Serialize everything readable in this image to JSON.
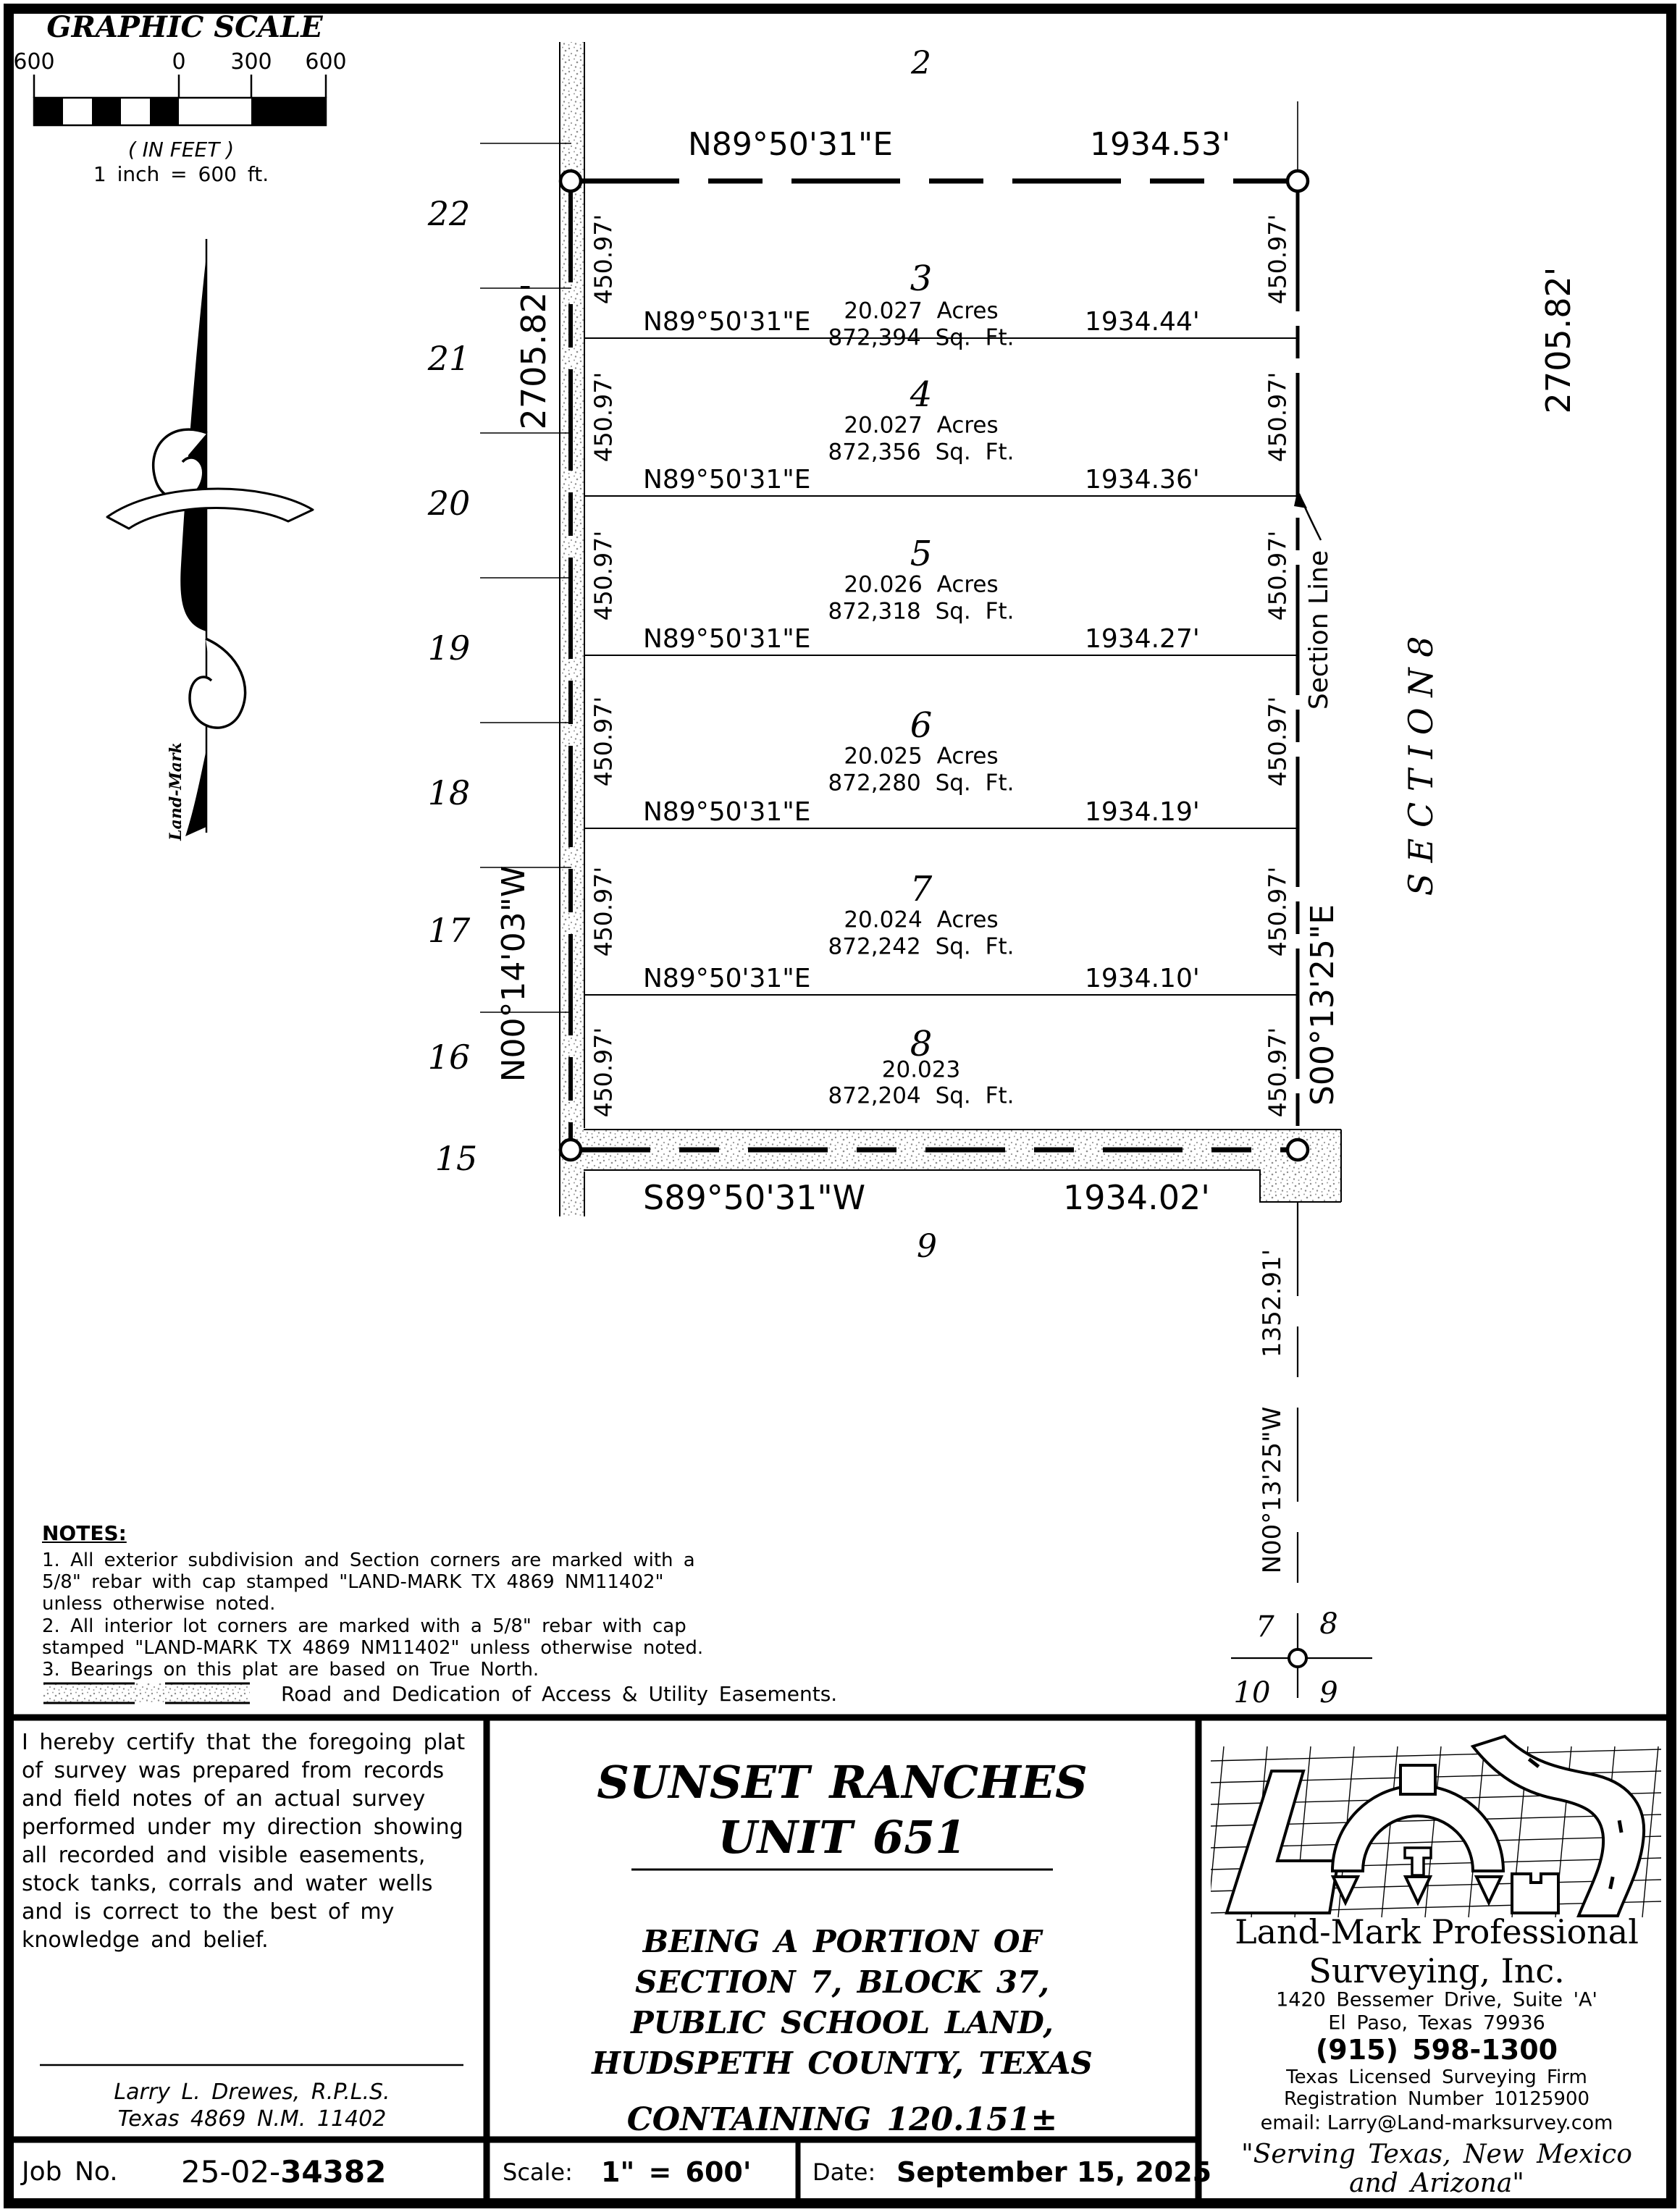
{
  "scale_bar": {
    "title": "GRAPHIC SCALE",
    "tick_labels": [
      "600",
      "0",
      "300",
      "600"
    ],
    "caption": "( IN FEET )",
    "equivalence": "1 inch  =  600 ft."
  },
  "north_arrow_label": "Land-Mark",
  "plat": {
    "north_neighbor": "2",
    "south_neighbor": "9",
    "west_neighbors": [
      "22",
      "21",
      "20",
      "19",
      "18",
      "17",
      "16",
      "15"
    ],
    "north_line": {
      "bearing": "N89°50'31\"E",
      "distance": "1934.53'"
    },
    "south_line": {
      "bearing": "S89°50'31\"W",
      "distance": "1934.02'"
    },
    "west_line": {
      "bearing": "N00°14'03\"W",
      "distance": "2705.82'"
    },
    "east_line": {
      "bearing": "S00°13'25\"E",
      "distance": "2705.82'"
    },
    "lots": [
      {
        "number": "3",
        "area_acres": "20.027 Acres",
        "area_sqft": "872,394 Sq. Ft.",
        "south_bearing": "N89°50'31\"E",
        "south_distance": "1934.44'",
        "side_length": "450.97'"
      },
      {
        "number": "4",
        "area_acres": "20.027 Acres",
        "area_sqft": "872,356 Sq. Ft.",
        "south_bearing": "N89°50'31\"E",
        "south_distance": "1934.36'",
        "side_length": "450.97'"
      },
      {
        "number": "5",
        "area_acres": "20.026 Acres",
        "area_sqft": "872,318 Sq. Ft.",
        "south_bearing": "N89°50'31\"E",
        "south_distance": "1934.27'",
        "side_length": "450.97'"
      },
      {
        "number": "6",
        "area_acres": "20.025 Acres",
        "area_sqft": "872,280 Sq. Ft.",
        "south_bearing": "N89°50'31\"E",
        "south_distance": "1934.19'",
        "side_length": "450.97'"
      },
      {
        "number": "7",
        "area_acres": "20.024 Acres",
        "area_sqft": "872,242 Sq. Ft.",
        "south_bearing": "N89°50'31\"E",
        "south_distance": "1934.10'",
        "side_length": "450.97'"
      },
      {
        "number": "8",
        "area_acres": "20.023",
        "area_sqft": "872,204 Sq. Ft.",
        "side_length": "450.97'"
      }
    ],
    "section_label": "S E C T I O N   8",
    "section_line_callout": "Section Line",
    "south_extension": {
      "distance": "1352.91'",
      "bearing": "N00°13'25\"W"
    },
    "section_corner": {
      "nw": "7",
      "ne": "8",
      "sw": "10",
      "se": "9"
    }
  },
  "notes": {
    "title": "NOTES:",
    "lines": [
      "1. All exterior subdivision and Section corners are marked with a",
      "5/8\" rebar with cap stamped \"LAND-MARK TX 4869 NM11402\"",
      "unless otherwise noted.",
      "2. All interior lot corners are marked with a 5/8\" rebar with cap",
      "stamped \"LAND-MARK TX 4869 NM11402\" unless otherwise noted.",
      "3. Bearings on this plat are based on True North."
    ]
  },
  "legend": {
    "road_easement": "Road and Dedication of Access & Utility Easements."
  },
  "certificate": {
    "lines": [
      "I hereby certify that the foregoing plat",
      "of survey was prepared from records",
      "and field notes of an actual survey",
      "performed under my direction showing",
      "all recorded and visible easements,",
      "stock tanks, corrals and water wells",
      "and is correct to the best of my",
      "knowledge and belief."
    ],
    "surveyor": "Larry L. Drewes, R.P.L.S.",
    "license": "Texas 4869 N.M. 11402"
  },
  "title_block": {
    "title_line1": "SUNSET RANCHES",
    "title_line2": "UNIT 651",
    "subtitle_lines": [
      "BEING A PORTION OF",
      "SECTION 7, BLOCK 37,",
      "PUBLIC SCHOOL LAND,",
      "HUDSPETH COUNTY, TEXAS"
    ],
    "containing": "CONTAINING 120.151±"
  },
  "firm": {
    "name_line1": "Land-Mark Professional",
    "name_line2": "Surveying, Inc.",
    "address1": "1420 Bessemer Drive, Suite 'A'",
    "address2": "El Paso, Texas   79936",
    "phone": "(915) 598-1300",
    "license1": "Texas Licensed Surveying Firm",
    "license2": "Registration Number 10125900",
    "email": "email: Larry@Land-marksurvey.com",
    "tagline1": "\"Serving Texas, New Mexico",
    "tagline2": "and Arizona\""
  },
  "footer": {
    "job_label": "Job No.",
    "job_prefix": "25-02-",
    "job_number": "34382",
    "scale_label": "Scale:",
    "scale_value": "1\" = 600'",
    "date_label": "Date:",
    "date_value": "September 15, 2025"
  }
}
